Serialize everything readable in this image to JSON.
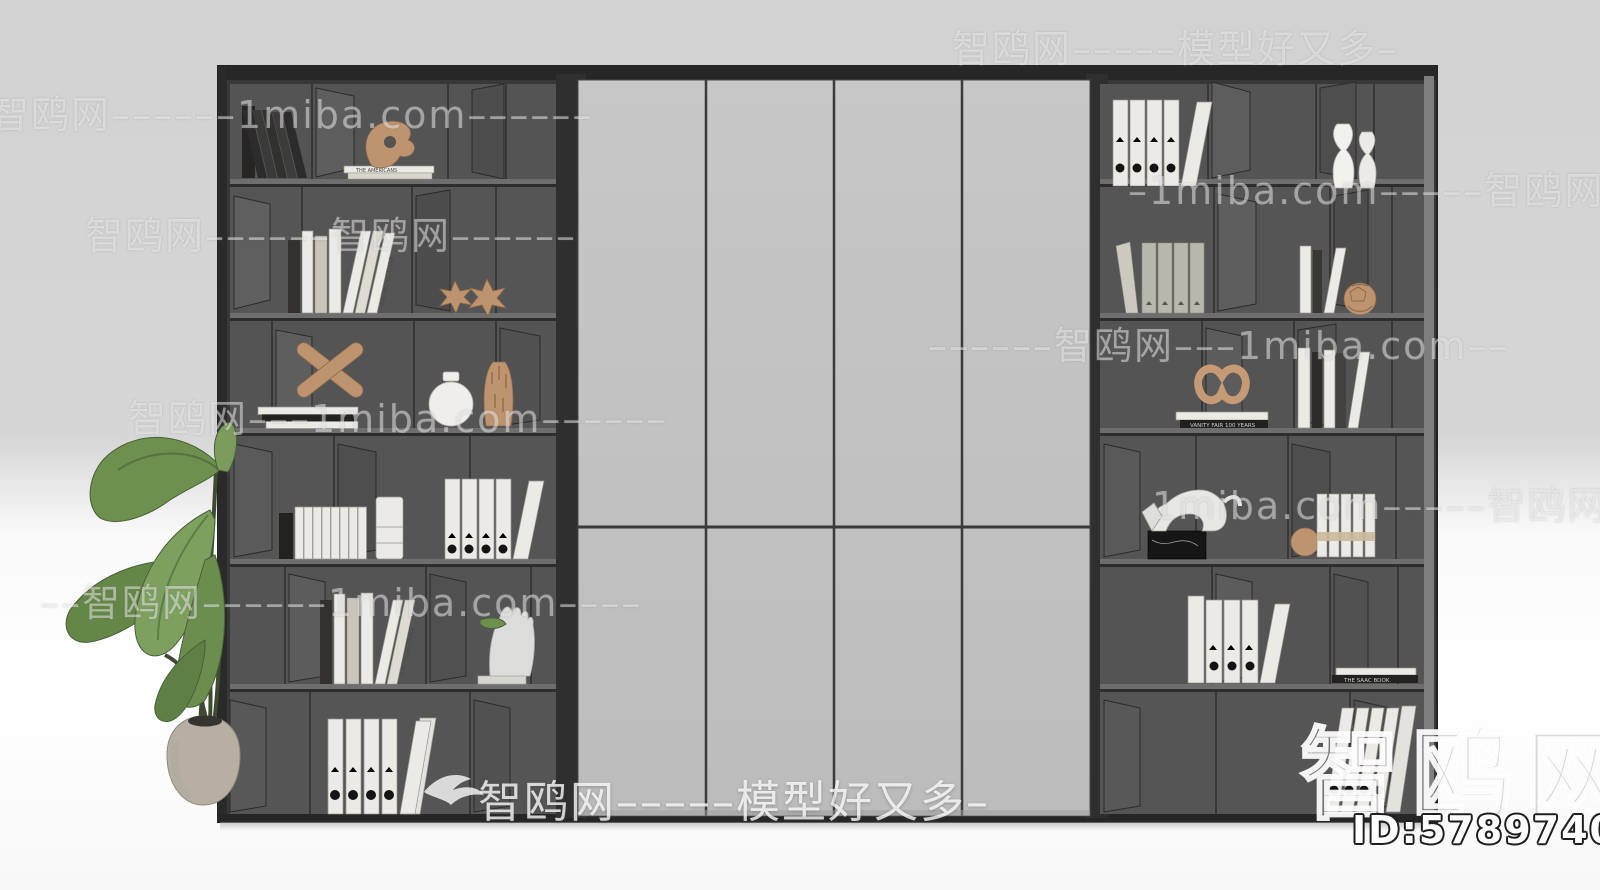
{
  "meta": {
    "site_name": "智鸥网",
    "site_domain": "1miba.com",
    "site_tagline": "模型好又多",
    "subject": "bookcase wall unit 3D model render with center cabinet doors and potted plant"
  },
  "watermarks": {
    "rows": [
      {
        "text": "智鸥网–––––模型好又多–"
      },
      {
        "text": "–智鸥网––––––1miba.com––––––"
      },
      {
        "text": "–1miba.com–––––智鸥网––"
      },
      {
        "text": "智鸥网––––––智鸥网––––––"
      },
      {
        "text": "––––––智鸥网–––1miba.com––"
      },
      {
        "text": "智鸥网–––1miba.com––––––"
      },
      {
        "text": "1miba.com–––––智鸥网––"
      },
      {
        "text": "––智鸥网––––––1miba.com––––"
      }
    ],
    "bottom": {
      "text": "智鸥网–––––模型好又多–"
    },
    "big_logo": "智鸥网",
    "model_id": "ID:578974014"
  },
  "colors": {
    "wall": "#d5d5d5",
    "floor": "#fdfdfd",
    "cabinet_frame": "#343434",
    "shelf_back": "#545454",
    "shelf_facet_light": "#5e5e5e",
    "shelf_facet_dark": "#4d4d4d",
    "door_panel": "#c2c2c2",
    "door_seam": "#3a3a3a",
    "white_items": "#eceae5",
    "tan_accent": "#bd946f",
    "leaf_green": "#6d904f",
    "pot": "#b6afa2"
  },
  "shelves": {
    "left_unit": {
      "rows": [
        {
          "items": [
            {
              "name": "leaning-dark-books",
              "spine_text": "WILLIAM SHAKESPEARE"
            },
            {
              "name": "abstract-sculpture-on-book-stack",
              "spine_text": "THE AMERICANS"
            }
          ]
        },
        {
          "items": [
            {
              "name": "standing-books",
              "spine_texts": [
                "FURNITURE DESIGN",
                "CLOTHING",
                "MODERN ARCHITECTURE",
                "ARCHITECTURE"
              ]
            },
            {
              "name": "spiky-star-ornaments",
              "count": 2
            }
          ]
        },
        {
          "items": [
            {
              "name": "x-jack-sculpture-on-book-stack"
            },
            {
              "name": "round-vase-white"
            },
            {
              "name": "carved-vase-tan"
            }
          ]
        },
        {
          "items": [
            {
              "name": "white-book-row"
            },
            {
              "name": "storage-canister"
            },
            {
              "name": "ring-binders-white",
              "count": 5
            }
          ]
        },
        {
          "items": [
            {
              "name": "standing-books",
              "spine_texts": [
                "FURNITURE DESIGN",
                "CLOTHING",
                "MODERN ARCHITECTURE",
                "ARCHITECTURE"
              ]
            },
            {
              "name": "marble-hand-sculpture"
            }
          ]
        },
        {
          "items": [
            {
              "name": "ring-binders-leaning",
              "count": 6
            }
          ]
        }
      ]
    },
    "right_unit": {
      "rows": [
        {
          "items": [
            {
              "name": "ring-binders-white",
              "count": 5
            },
            {
              "name": "sculptural-vases-white",
              "count": 2
            }
          ]
        },
        {
          "items": [
            {
              "name": "binder-books-gray"
            },
            {
              "name": "standing-books",
              "spine_texts": [
                "MODERN ARCHITECTURE",
                "ARCHITECTURE"
              ]
            },
            {
              "name": "geodesic-sphere-tan"
            }
          ]
        },
        {
          "items": [
            {
              "name": "knot-sculpture-on-book-stack",
              "spine_text": "VANITY FAIR 100 YEARS"
            },
            {
              "name": "standing-books-cluster"
            }
          ]
        },
        {
          "items": [
            {
              "name": "origami-panther-on-marble-base"
            },
            {
              "name": "white-books-with-band"
            },
            {
              "name": "sphere-tan"
            }
          ]
        },
        {
          "items": [
            {
              "name": "ring-binders-white",
              "count": 5
            },
            {
              "name": "thin-book-stack",
              "spine_text": "THE SAAC BOOK"
            }
          ]
        },
        {
          "items": [
            {
              "name": "ring-binders-leaning",
              "count": 5
            }
          ]
        }
      ]
    },
    "center_doors": {
      "panel_count": 4,
      "seam_rows": 2
    },
    "plant": {
      "type": "potted-leafy-plant",
      "position": "front-left"
    }
  }
}
